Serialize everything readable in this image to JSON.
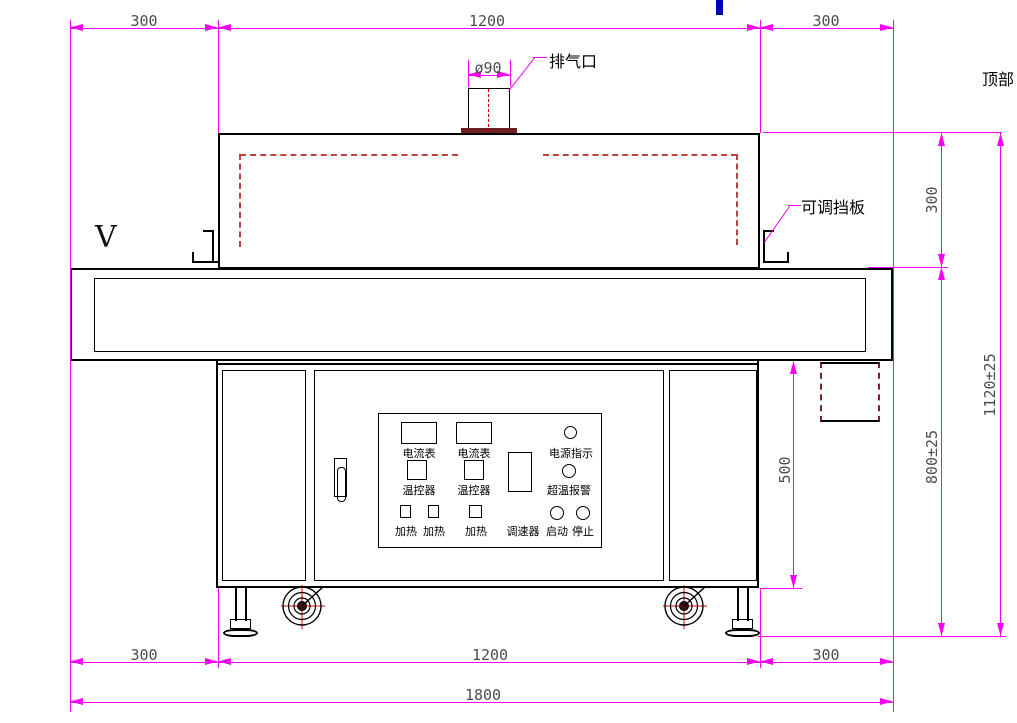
{
  "drawing": {
    "view_marker": "V",
    "labels": {
      "exhaust_port": "排气口",
      "exhaust_diameter": "ø90",
      "adjustable_baffle": "可调挡板",
      "top": "顶部"
    },
    "dimensions": {
      "top_left": "300",
      "top_center": "1200",
      "top_right": "300",
      "tunnel_height": "300",
      "total_height": "1120±25",
      "body_height": "800±25",
      "cabinet_height": "500",
      "bottom_left": "300",
      "bottom_center": "1200",
      "bottom_right": "300",
      "overall_width": "1800"
    },
    "control_panel": {
      "ammeters": [
        "电流表",
        "电流表"
      ],
      "temperature_controllers": [
        "温控器",
        "温控器"
      ],
      "heaters": [
        "加热",
        "加热",
        "加热"
      ],
      "speed_controller": "调速器",
      "power_indicator": "电源指示",
      "overtemp_alarm": "超温报警",
      "start": "启动",
      "stop": "停止"
    },
    "colors": {
      "dimension_line": "#f500f5",
      "dimension_text": "#4d4d4d",
      "drawing_line": "#000000",
      "duct_dashed": "#c04040",
      "centerline_red": "#cc0000",
      "flange": "#6d2020",
      "blue_mark": "#0000bb"
    }
  }
}
